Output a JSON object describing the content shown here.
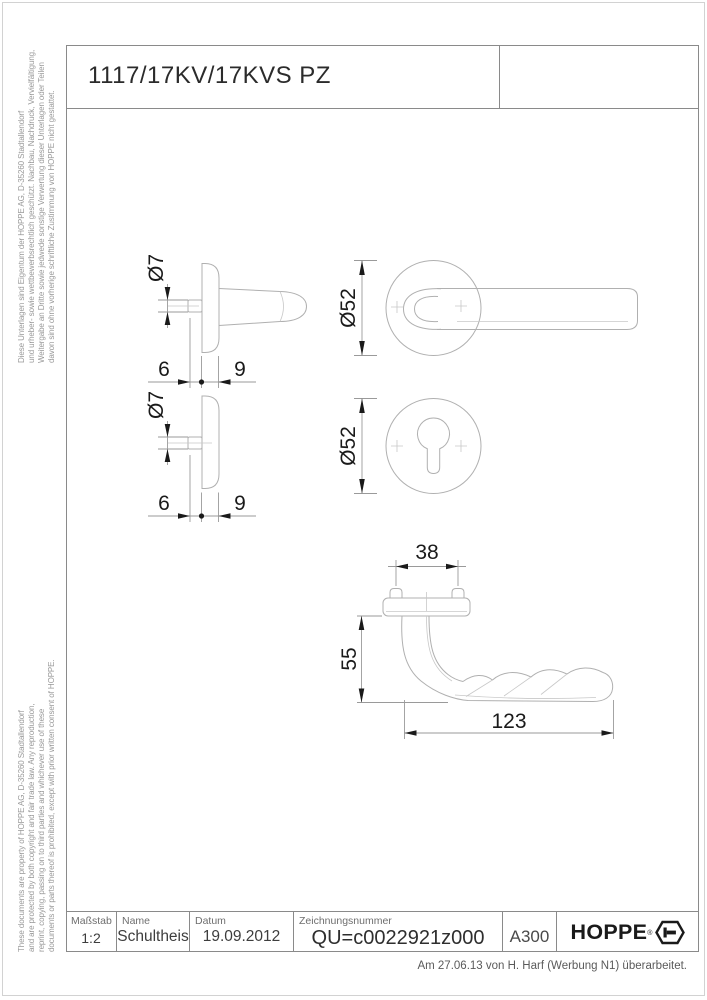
{
  "title": "1117/17KV/17KVS PZ",
  "side_notes": {
    "german": [
      "Diese Unterlagen sind Eigentum der HOPPE AG, D-35260 Stadtallendorf",
      "und urheber- sowie wettbewerbsrechtlich geschützt. Nachbau, Nachdruck, Vervielfältigung,",
      "Weitergabe an Dritte sowie jedwede sonstige Verwertung dieser Unterlagen oder Teilen",
      "davon sind ohne vorherige schriftliche Zustimmung von HOPPE nicht gestattet."
    ],
    "english": [
      "These documents are property of HOPPE AG, D-35260 Stadtallendorf",
      "and are protected by both copyright and fair trade law. Any reproduction,",
      "reprint, copying, passing on to third parties and whichever use of these",
      "documents or parts thereof is prohibited, except with prior written consent of HOPPE."
    ]
  },
  "drawing": {
    "dims": {
      "pin_d": "Ø7",
      "rosette_d": "Ø52",
      "offset_front": "6",
      "offset_back": "9",
      "screw_distance": "38",
      "handle_drop": "55",
      "handle_length": "123"
    }
  },
  "title_block": {
    "scale_label": "Maßstab",
    "scale_value": "1:2",
    "name_label": "Name",
    "name_value": "Schultheis",
    "date_label": "Datum",
    "date_value": "19.09.2012",
    "drawing_number_label": "Zeichnungsnummer",
    "drawing_number_value": "QU=c0022921z000",
    "revision": "A300",
    "brand": "HOPPE",
    "brand_mark": "®"
  },
  "footer_note": "Am 27.06.13 von H. Harf (Werbung N1) überarbeitet.",
  "colors": {
    "frame": "#8a8a8a",
    "part_outline": "#b0b0b0",
    "dimension_line": "#9a9a9a",
    "ink": "#1a1a1a",
    "muted_label": "#6e6e6e"
  }
}
